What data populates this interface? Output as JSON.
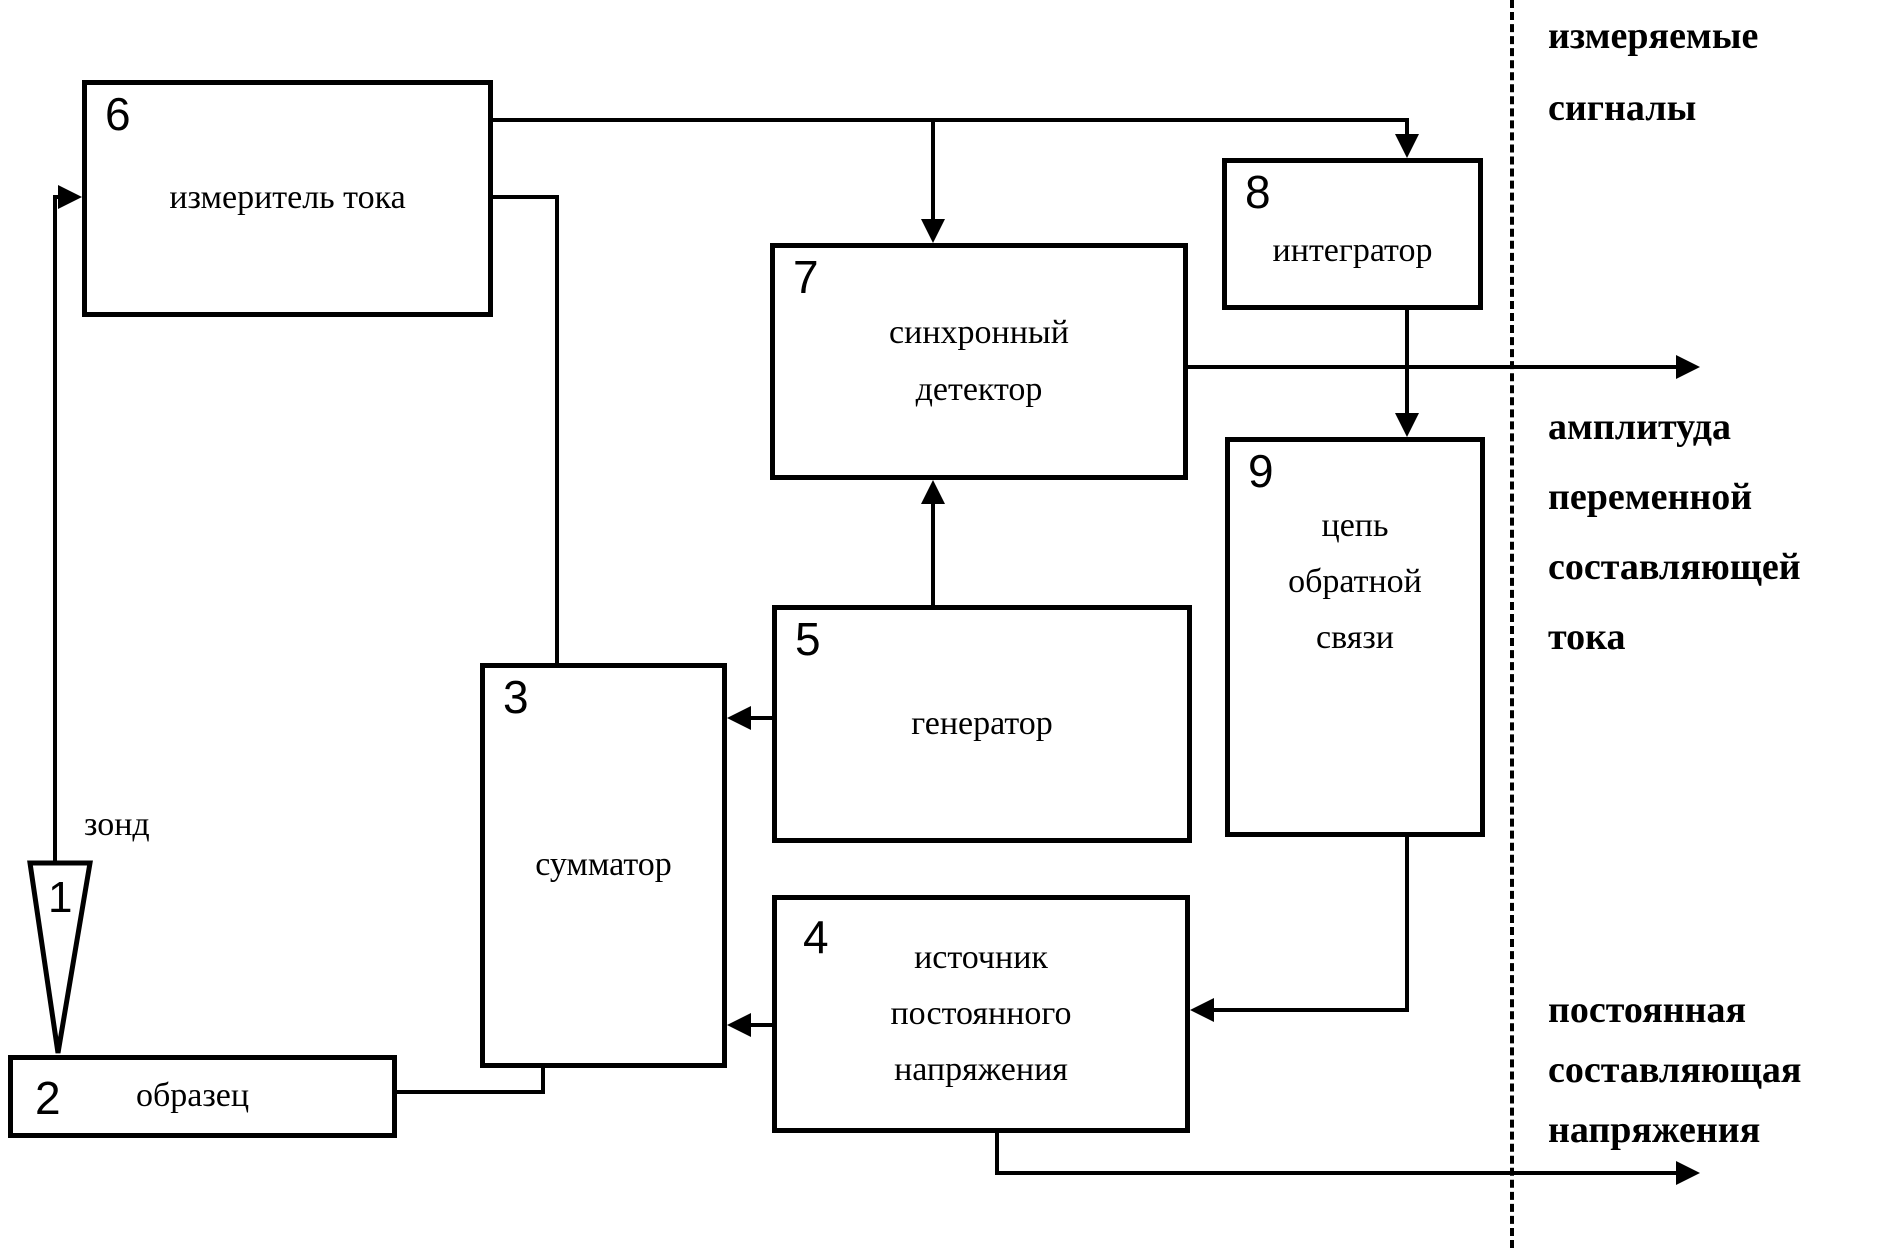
{
  "canvas": {
    "width": 1893,
    "height": 1248
  },
  "colors": {
    "ink": "#000000",
    "background": "#ffffff"
  },
  "blocks": {
    "probe": {
      "number": "1",
      "label": "зонд"
    },
    "sample": {
      "number": "2",
      "label": "образец"
    },
    "summer": {
      "number": "3",
      "label": "сумматор"
    },
    "dc_source": {
      "number": "4",
      "label": "источник постоянного напряжения"
    },
    "generator": {
      "number": "5",
      "label": "генератор"
    },
    "current_meter": {
      "number": "6",
      "label": "измеритель тока"
    },
    "sync_detector": {
      "number": "7",
      "label": "синхронный детектор"
    },
    "integrator": {
      "number": "8",
      "label": "интегратор"
    },
    "feedback": {
      "number": "9",
      "label": "цепь обратной связи"
    }
  },
  "annotations": {
    "measured_signals": {
      "lines": [
        "измеряемые",
        "сигналы"
      ]
    },
    "ac_amplitude": {
      "lines": [
        "амплитуда",
        "переменной",
        "составляющей",
        "тока"
      ]
    },
    "dc_component": {
      "lines": [
        "постоянная",
        "составляющая",
        "напряжения"
      ]
    }
  }
}
